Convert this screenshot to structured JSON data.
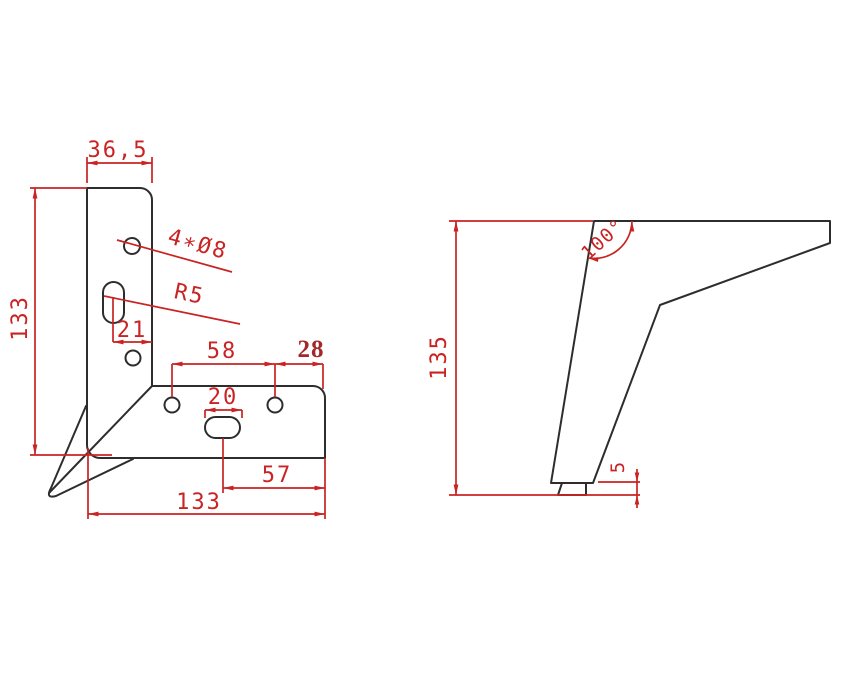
{
  "drawing_type": "technical-dimension-drawing",
  "colors": {
    "background": "#ffffff",
    "part_outline": "#2d2d2d",
    "dimension": "#c92323",
    "dimension_bold": "#a3282a"
  },
  "front_view": {
    "dims": {
      "top_width": "36,5",
      "left_height": "133",
      "holes_callout": "4∗Ø8",
      "slot_radius": "R5",
      "slot_offset": "21",
      "hole_spacing": "58",
      "hole_edge_offset": "28",
      "slot_width": "20",
      "slot_to_edge": "57",
      "bottom_width": "133"
    }
  },
  "side_view": {
    "dims": {
      "height": "135",
      "apex_angle": "100°",
      "foot_height": "5"
    }
  }
}
